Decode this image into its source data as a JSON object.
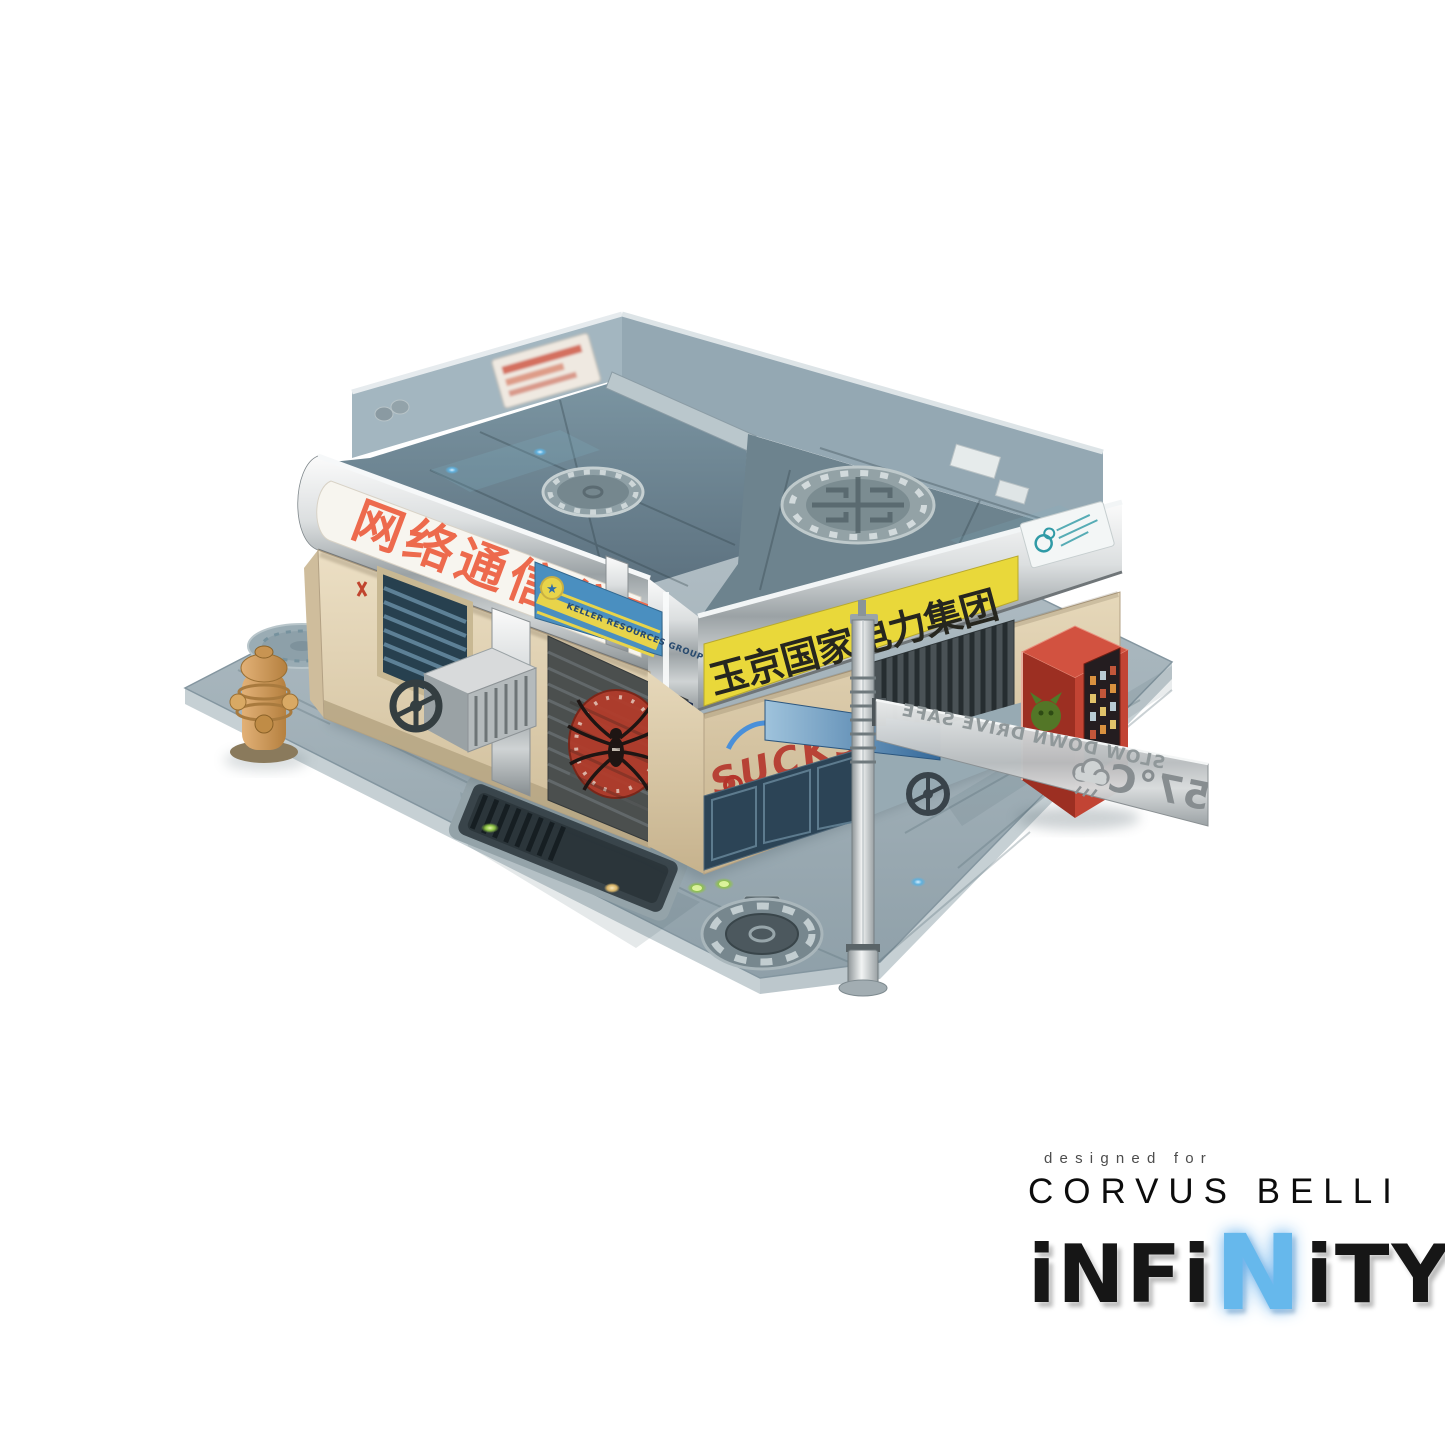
{
  "signs": {
    "banner_left_cn": "网络通信公司",
    "banner_front_cn": "玉京国家电力集团",
    "keller": "KELLER RESOURCES GROUP",
    "open": "OPEN",
    "graffiti": "SUCKS",
    "street_warning": "SLOW DOWN DRIVE SAFE",
    "street_temp": "57°C"
  },
  "branding": {
    "designed_for": "designed for",
    "studio": "CORVUS BELLI",
    "logo_prefix": "iNFi",
    "logo_accent": "N",
    "logo_suffix": "iTY"
  },
  "colors": {
    "banner_yellow": "#e9d83a",
    "banner_text_red": "#ed6a4d",
    "banner_text_black": "#26261f",
    "keller_blue": "#4a8fc0",
    "spider_red": "#b23c2b",
    "graffiti_red": "#b5352b",
    "graffiti_blue": "#4a90d9",
    "vending_red": "#c24434",
    "infinity_blue": "#66b8ec"
  },
  "icons": {
    "spider": "spider-logo-icon",
    "storm": "storm-cloud-icon",
    "star": "star-emblem-icon",
    "mascot": "green-mascot-icon",
    "teal_logo": "teal-company-logo-icon"
  }
}
